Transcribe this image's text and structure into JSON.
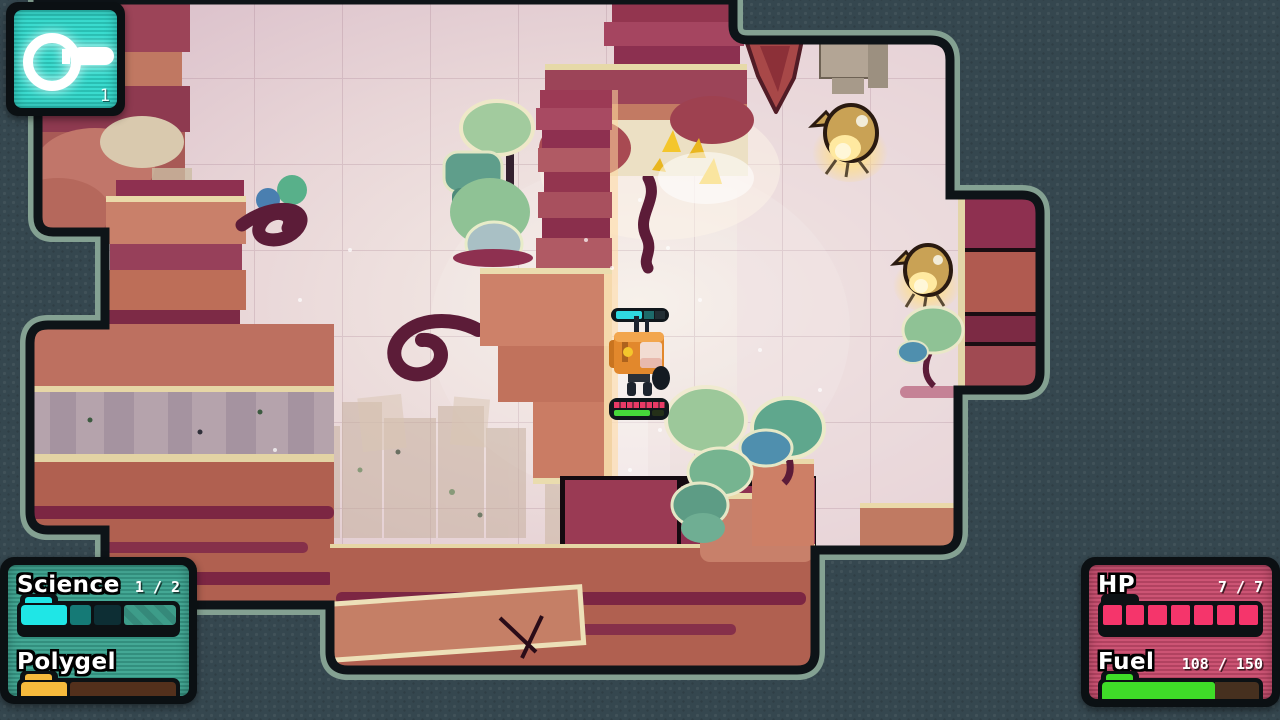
{
  "hud": {
    "key_counter": {
      "count": "1"
    },
    "resources": {
      "science_label": "Science",
      "science_value": "1 / 2",
      "science_segments": [
        {
          "color": "#1fe6e6",
          "width": 46
        },
        {
          "color": "#157a76",
          "width": 21
        },
        {
          "color": "#0d2e34",
          "width": 27
        }
      ],
      "polygel_label": "Polygel",
      "polygel_fill": {
        "color": "#f6ba3c",
        "width": 46
      }
    },
    "vitals": {
      "hp_label": "HP",
      "hp_value": "7 / 7",
      "hp_segments": 7,
      "hp_segment_color": "#f5356b",
      "fuel_label": "Fuel",
      "fuel_value": "108 / 150",
      "fuel_percent": 72,
      "fuel_color": "#3fdc28"
    }
  },
  "colors": {
    "background": "#35474f",
    "level_outline": "#84a192",
    "level_border": "#0e1418",
    "level_interior": "#d9bcca",
    "key_screen": "#2fd9cc",
    "resources_screen": "#3aa38f",
    "vitals_screen": "#c94b6d"
  }
}
